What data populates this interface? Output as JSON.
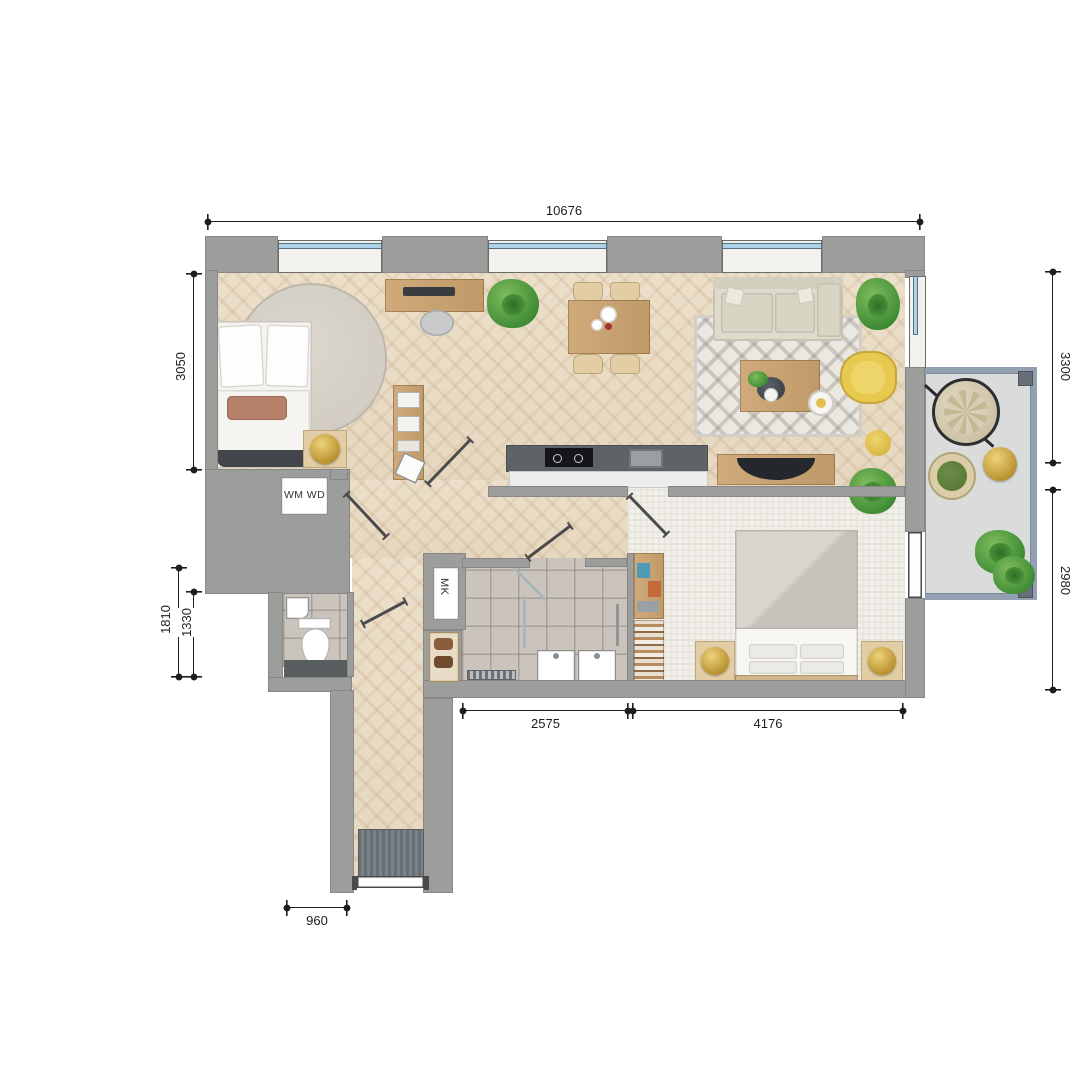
{
  "dimensions": {
    "top": "10676",
    "bedroom1_height": "3050",
    "left_outer": "1810",
    "left_inner": "1330",
    "balcony_upper": "3300",
    "balcony_lower": "2980",
    "bath_zone_width": "2575",
    "bedroom2_width": "4176",
    "entry_width": "960"
  },
  "labels": {
    "washer_dryer": "WM WD",
    "meter_closet": "MK"
  },
  "colors": {
    "wall": "#9d9d9c",
    "wood_floor": "#e9dcc6",
    "tile_floor": "#cac4bd",
    "carpet_floor": "#f1efe9",
    "balcony_rail": "#92a0b2",
    "balcony_floor": "#dadcdb",
    "window_glass": "#aed3e8",
    "accent_yellow": "#e8c94f",
    "accent_gold": "#c9a53f",
    "plant_green": "#4f9b3e",
    "kitchen_counter": "#606366",
    "furniture_wood": "#c8a577"
  }
}
